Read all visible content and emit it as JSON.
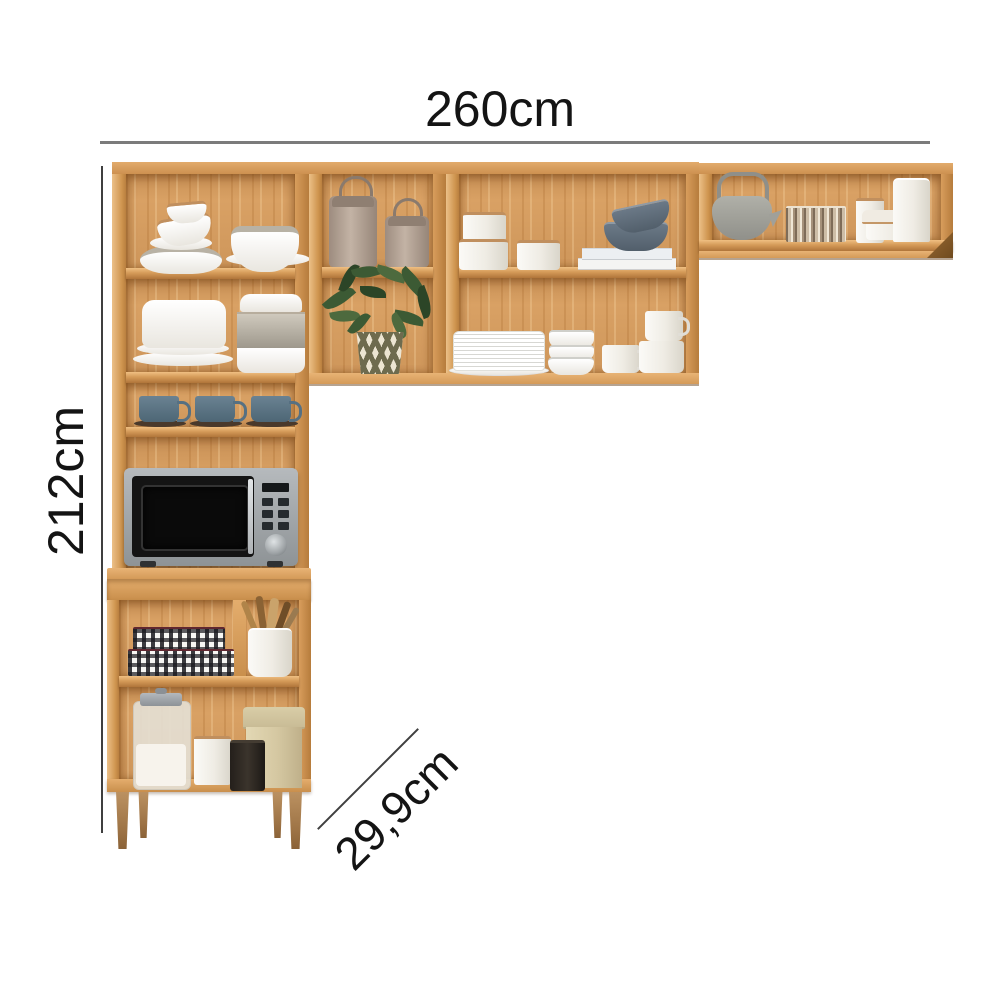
{
  "title": "Kitchen cabinet set dimension diagram",
  "dimensions": {
    "width": "260cm",
    "height": "212cm",
    "depth": "29,9cm"
  },
  "colors": {
    "background": "#ffffff",
    "wood": "#d49a5b",
    "wood_light": "#e6b87c",
    "wood_dark": "#a9763b",
    "dimension_line_gray": "#7b7b7b",
    "dimension_line_dark": "#3f3f3f",
    "text": "#141414",
    "mug_blue": "#5b7483",
    "microwave_silver": "#a7abae",
    "microwave_door": "#141414",
    "plant_green": "#3c5a34",
    "metallic_rim": "#c08f5e",
    "gingham_dark": "#19191e",
    "taupe_canister": "#b5a294"
  },
  "scene": {
    "items": [
      "stacked plates and bowls",
      "bowl with metallic rim",
      "white dish stack",
      "glass container with metallic band",
      "blue coffee mugs on saucers",
      "microwave oven",
      "gingham storage boxes",
      "utensil crock with wooden utensils",
      "glass flour jar",
      "white canister",
      "black canister",
      "cream storage tin",
      "taupe lidded cans with handles",
      "potted plant in chevron pot",
      "white canisters with copper rims",
      "stacked books",
      "gray bowls",
      "plate stack",
      "bowl stack",
      "white mugs",
      "gray teapot",
      "metallic tumblers",
      "white storage jars"
    ]
  }
}
